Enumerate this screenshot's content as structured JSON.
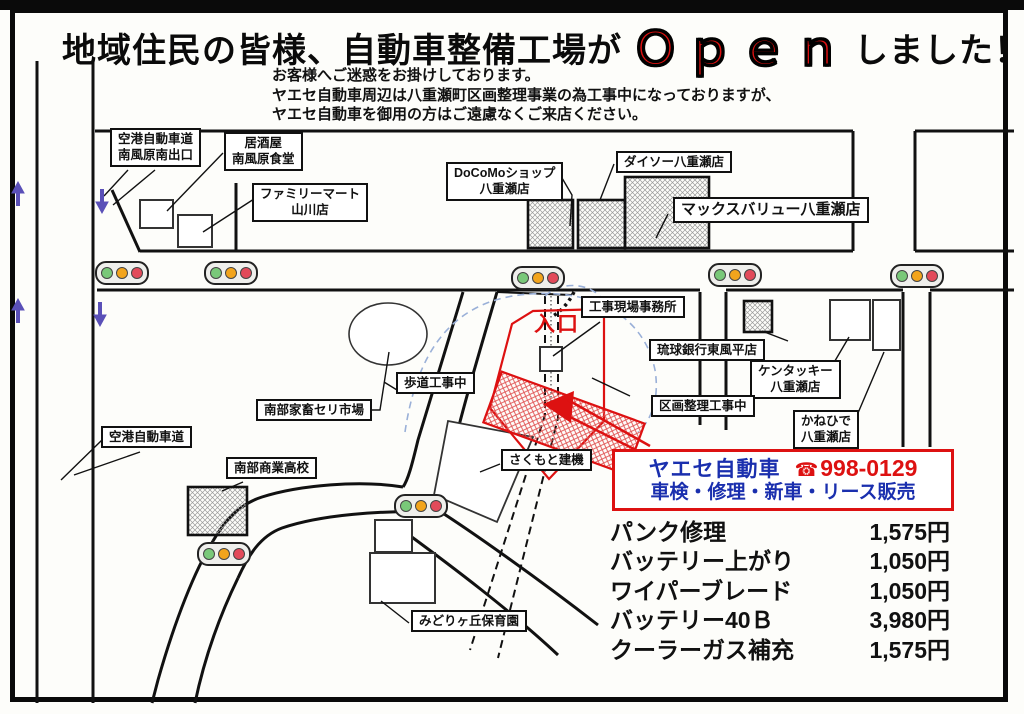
{
  "colors": {
    "accent_red": "#dd1111",
    "accent_blue": "#1a2fae",
    "signal_green": "#79c879",
    "signal_yellow": "#f2a41c",
    "signal_red": "#e24a5a",
    "arrow_purple": "#5a50b8",
    "construction_dash_blue": "#9ab0d8"
  },
  "title": {
    "prefix": "地域住民の皆様、自動車整備工場が",
    "highlight": "Ｏｐｅｎ",
    "suffix": "しました！"
  },
  "notice": {
    "line1": "お客様へご迷惑をお掛けしております。",
    "line2": "ヤエセ自動車周辺は八重瀬町区画整理事業の為工事中になっておりますが、",
    "line3": "ヤエセ自動車を御用の方はご遠慮なくご来店ください。"
  },
  "map": {
    "entrance_label": "入口",
    "labels": {
      "airport_exit": {
        "line1": "空港自動車道",
        "line2": "南風原南出口"
      },
      "izakaya": {
        "line1": "居酒屋",
        "line2": "南風原食堂"
      },
      "familymart": {
        "line1": "ファミリーマート",
        "line2": "山川店"
      },
      "docomo": {
        "line1": "DoCoMoショップ",
        "line2": "八重瀬店"
      },
      "daiso": {
        "line1": "ダイソー八重瀬店"
      },
      "maxvalu": {
        "line1": "マックスバリュー八重瀬店"
      },
      "site_office": {
        "line1": "工事現場事務所"
      },
      "ryukyu_bank": {
        "line1": "琉球銀行東風平店"
      },
      "kfc": {
        "line1": "ケンタッキー",
        "line2": "八重瀬店"
      },
      "kanehide": {
        "line1": "かねひで",
        "line2": "八重瀬店"
      },
      "land_readjustment": {
        "line1": "区画整理工事中"
      },
      "sidewalk_construction": {
        "line1": "歩道工事中"
      },
      "cattle_market": {
        "line1": "南部家畜セリ市場"
      },
      "airport_expressway": {
        "line1": "空港自動車道"
      },
      "commercial_high_school": {
        "line1": "南部商業高校"
      },
      "sakumoto": {
        "line1": "さくもと建機"
      },
      "midorigaoka": {
        "line1": "みどりヶ丘保育園"
      }
    }
  },
  "shop_box": {
    "name": "ヤエセ自動車",
    "phone_icon": "☎",
    "phone": "998-0129",
    "services": "車検・修理・新車・リース販売"
  },
  "price_list": [
    {
      "item": "パンク修理",
      "price": "1,575円"
    },
    {
      "item": "バッテリー上がり",
      "price": "1,050円"
    },
    {
      "item": "ワイパーブレード",
      "price": "1,050円"
    },
    {
      "item": "バッテリー40Ｂ",
      "price": "3,980円"
    },
    {
      "item": "クーラーガス補充",
      "price": "1,575円"
    }
  ]
}
